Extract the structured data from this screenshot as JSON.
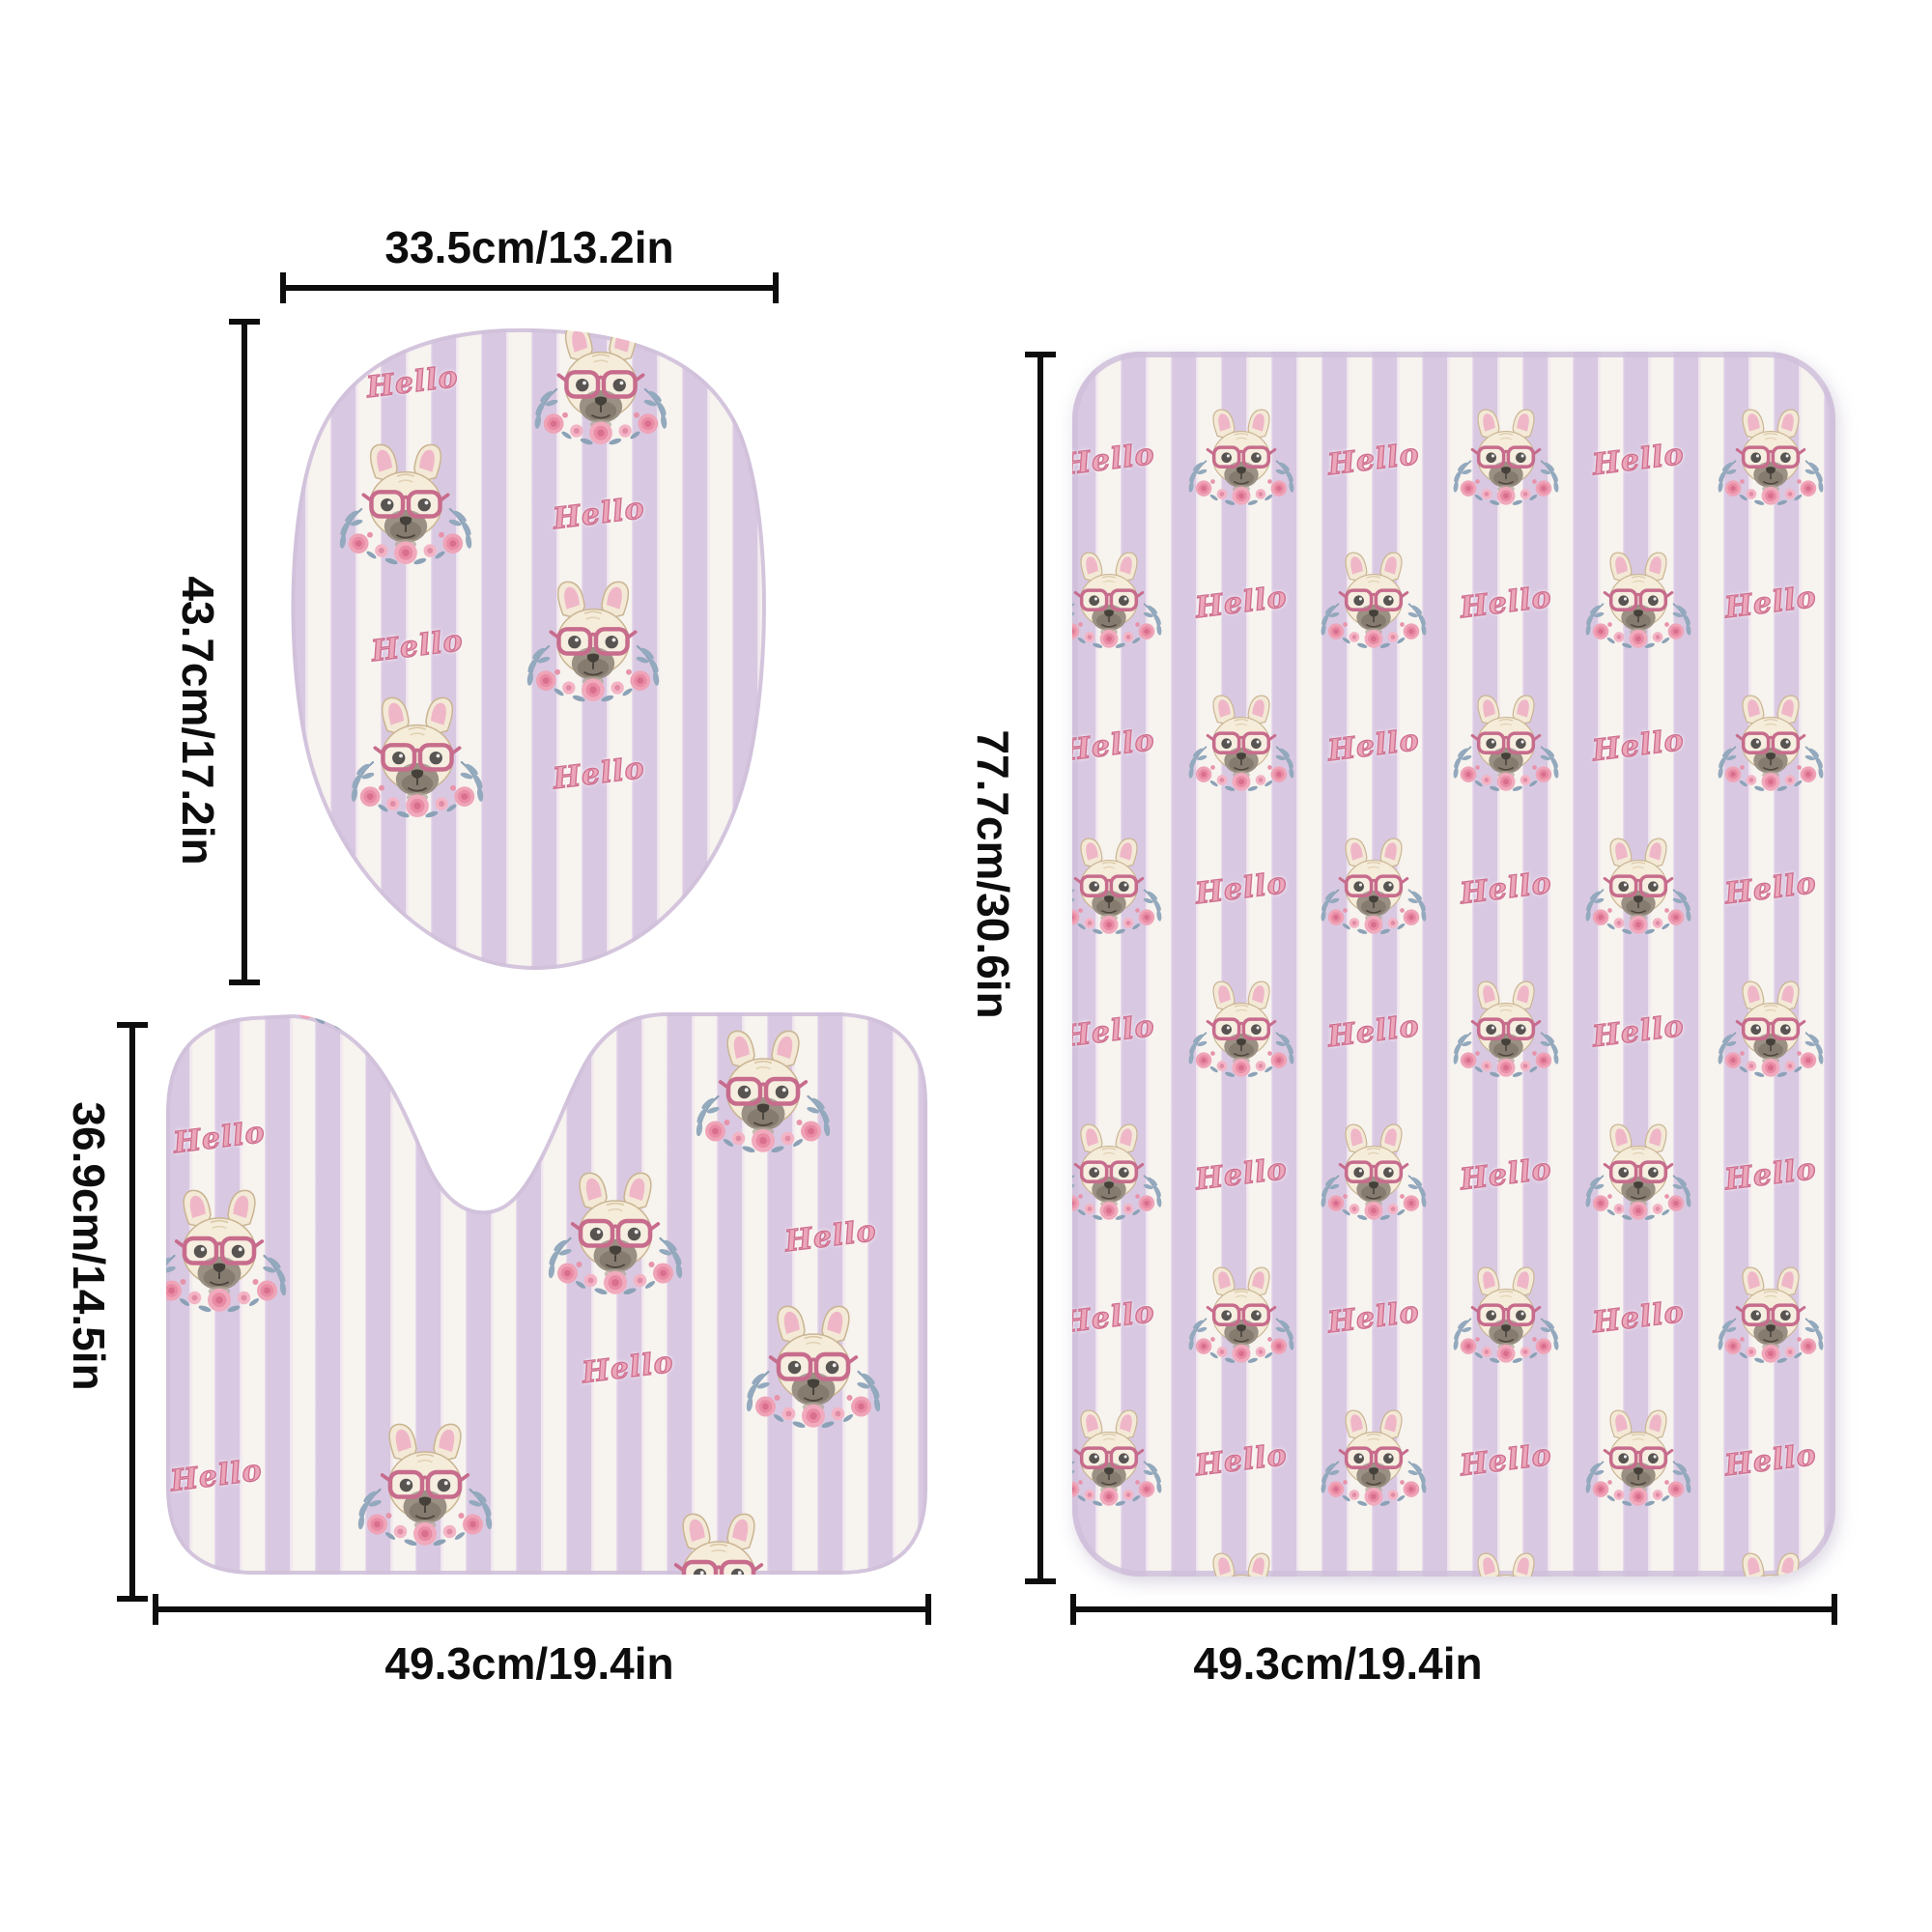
{
  "diagram": {
    "background": "#ffffff",
    "pattern": {
      "hello_text": "Hello",
      "motif": "french-bulldog-face-with-pink-glasses-and-floral-wreath",
      "stripe_direction": "vertical"
    },
    "colors": {
      "stripe_lavender": "#d9c8e2",
      "stripe_white": "#f7f3ef",
      "hello_pink": "#eba6ba",
      "hello_outline": "#cf7090",
      "glasses_pink": "#c76c8c",
      "dimension_line": "#0d0d0d"
    },
    "items": [
      {
        "id": "toilet-lid-cover",
        "shape": "oval",
        "width_label": "33.5cm/13.2in",
        "height_label": "43.7cm/17.2in"
      },
      {
        "id": "contour-mat",
        "shape": "u-shaped",
        "width_label": "49.3cm/19.4in",
        "height_label": "36.9cm/14.5in"
      },
      {
        "id": "bath-mat",
        "shape": "rectangle",
        "width_label": "49.3cm/19.4in",
        "height_label": "77.7cm/30.6in"
      }
    ]
  }
}
